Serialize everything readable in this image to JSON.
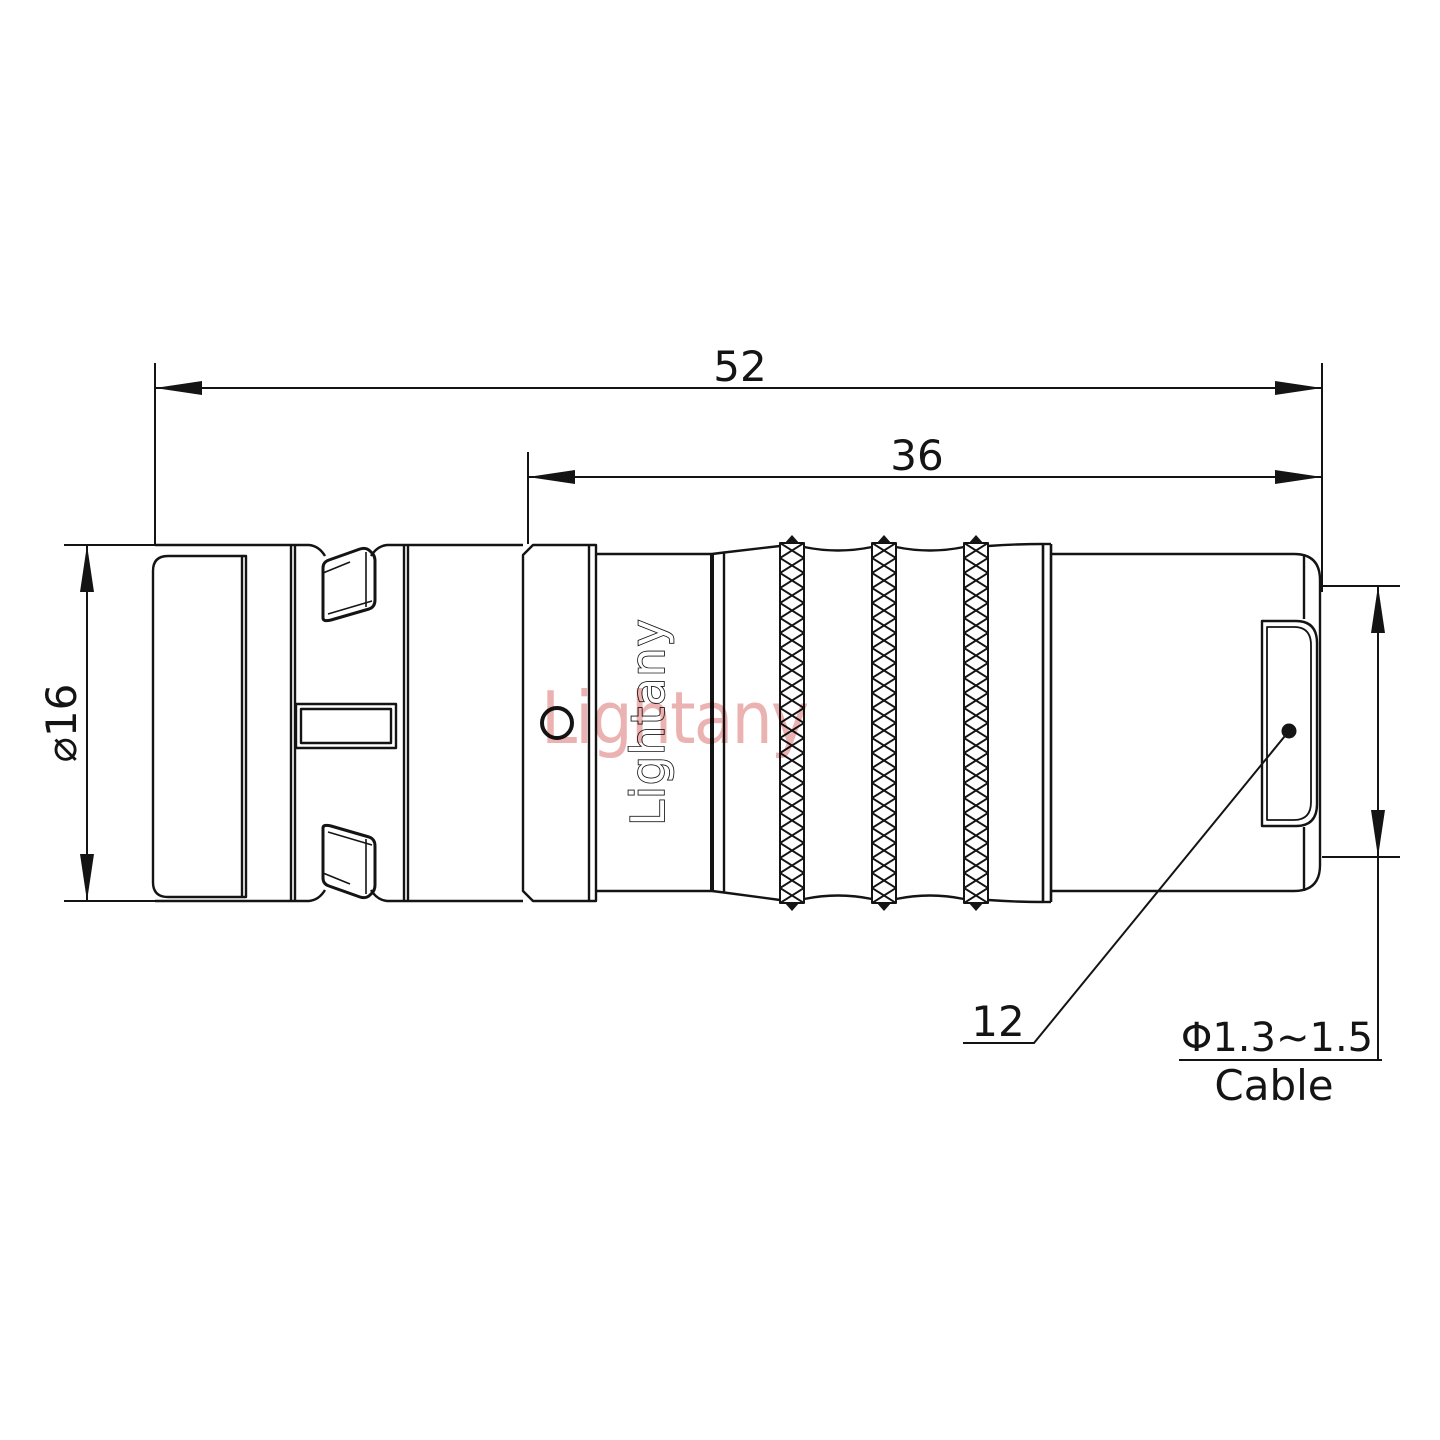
{
  "drawing": {
    "type": "connector-technical-drawing",
    "dimensions": {
      "overall_length": "52",
      "barrel_length": "36",
      "front_diameter": "⌀16",
      "rear_diameter": "12",
      "cable_diameter": "Φ1.3~1.5",
      "cable_word": "Cable"
    },
    "branding": {
      "logo_text": "Lightany",
      "watermark_text": "Lightany"
    },
    "colors": {
      "line": "#141414",
      "watermark_pink": "#e8a4a4",
      "background": "#ffffff"
    }
  }
}
